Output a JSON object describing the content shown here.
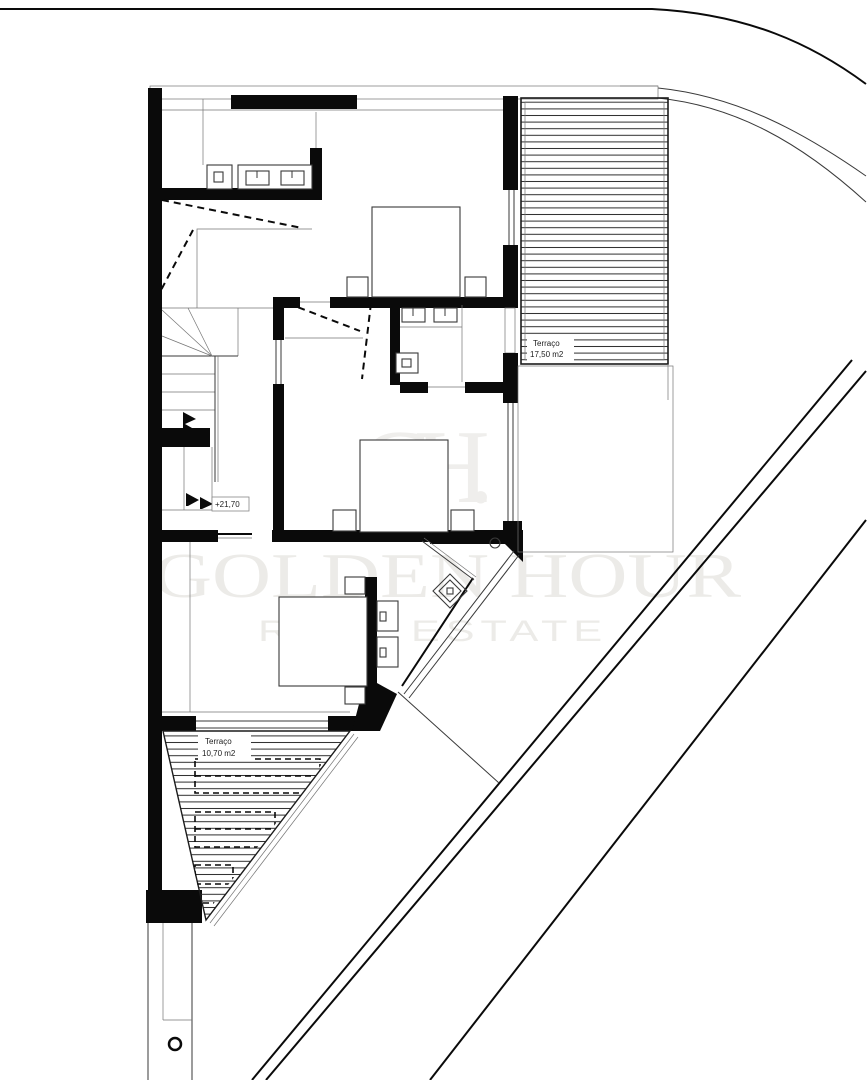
{
  "labels": {
    "terrace_right": {
      "name": "Terraço",
      "area": "17,50 m2"
    },
    "terrace_bottom": {
      "name": "Terraço",
      "area": "10,70 m2"
    },
    "level": "+21,70"
  },
  "watermark": {
    "monogram": "GH.",
    "line1": "GOLDEN HOUR",
    "line2": "REAL ESTATE"
  },
  "colors": {
    "paper": "#ffffff",
    "wall": "#0a0a0a",
    "line": "#3a3a3a",
    "thin": "#757575",
    "watermark": "#ecebe8",
    "watermark2": "#efeeec"
  }
}
